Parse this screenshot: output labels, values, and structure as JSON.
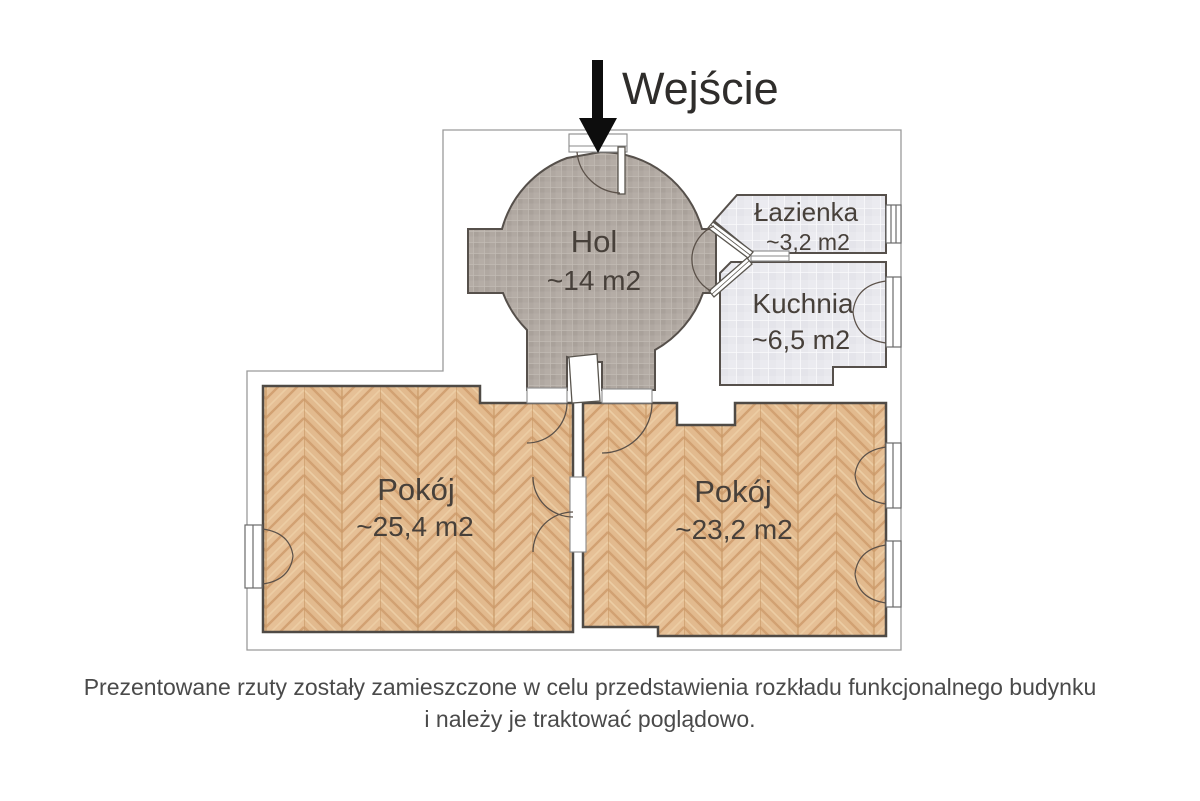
{
  "entrance": {
    "label": "Wejście"
  },
  "rooms": {
    "hol": {
      "name": "Hol",
      "area": "~14 m2"
    },
    "lazienka": {
      "name": "Łazienka",
      "area": "~3,2 m2"
    },
    "kuchnia": {
      "name": "Kuchnia",
      "area": "~6,5 m2"
    },
    "pokoj_left": {
      "name": "Pokój",
      "area": "~25,4 m2"
    },
    "pokoj_right": {
      "name": "Pokój",
      "area": "~23,2 m2"
    }
  },
  "note": {
    "line1": "Prezentowane rzuty zostały zamieszczone w celu przedstawienia rozkładu funkcjonalnego budynku",
    "line2": "i należy je traktować poglądowo."
  },
  "colors": {
    "wood": "#e2ba8e",
    "wood_stripe": "#d2a172",
    "hol_tile": "#b0a8a1",
    "hol_tile_alt": "#a9a19a",
    "light_tile": "#e8e8ed",
    "wall": "#4f4a45",
    "outline": "#9a9a9a",
    "arrow": "#0d0d0d",
    "label": "#47403a",
    "note_text": "#4a4a4a"
  }
}
